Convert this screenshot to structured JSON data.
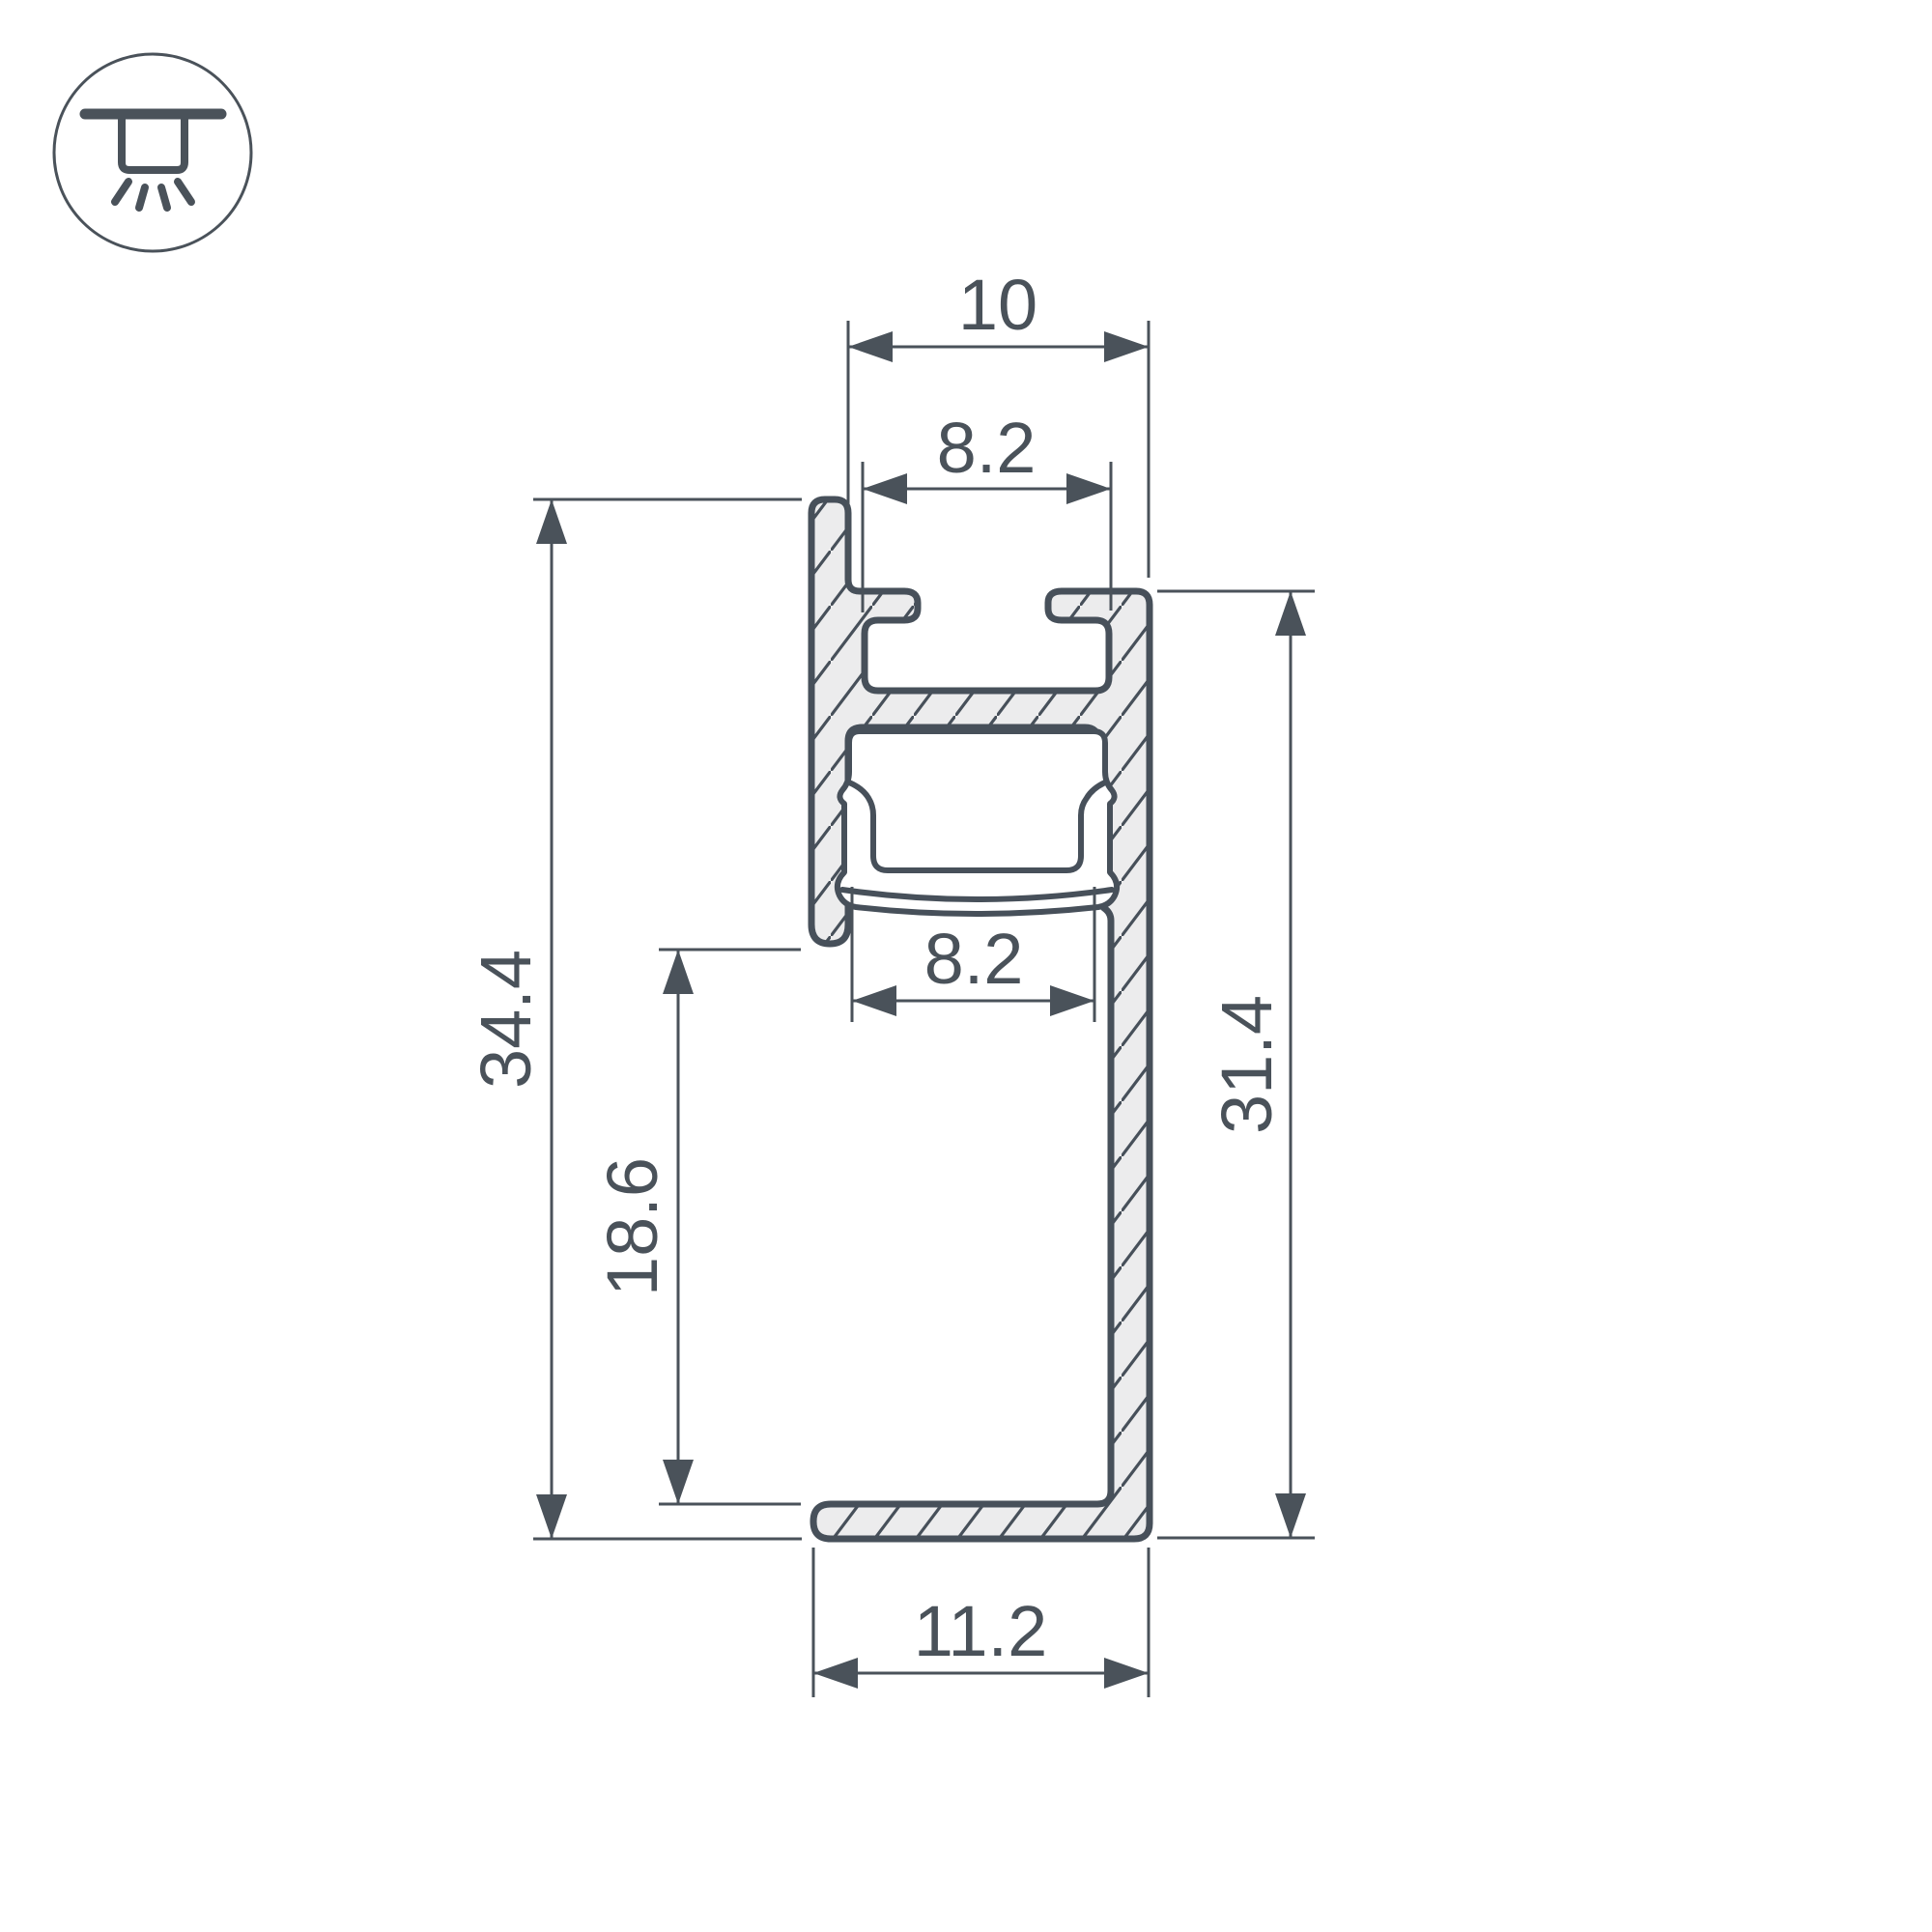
{
  "icon_badge": {
    "type": "recessed-ceiling-light",
    "stroke_color": "#4a525a"
  },
  "drawing": {
    "type": "led-profile-cross-section",
    "line_color": "#47505a",
    "metal_fill": "#ececed",
    "background": "#ffffff",
    "dimensions": {
      "top_outer_width": "10",
      "top_slot_inner_width": "8.2",
      "diffuser_opening_width": "8.2",
      "overall_height": "34.4",
      "wall_to_base_clearance": "18.6",
      "body_height": "31.4",
      "base_width": "11.2"
    }
  }
}
